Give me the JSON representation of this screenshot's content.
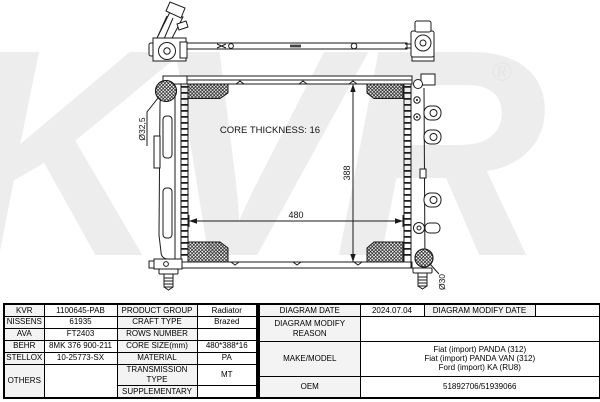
{
  "watermark": {
    "text": "KVR",
    "registered_mark": "®"
  },
  "drawing": {
    "core_thickness_label": "CORE THICKNESS: 16",
    "core_width_dim": "480",
    "core_height_dim": "388",
    "inlet_diameter_label": "Ø32,5",
    "outlet_diameter_label": "Ø30"
  },
  "spec_table": {
    "left": {
      "rows": [
        {
          "brand": "KVR",
          "part_number": "1100645-PAB",
          "property": "PRODUCT GROUP",
          "value": "Radiator"
        },
        {
          "brand": "NISSENS",
          "part_number": "61935",
          "property": "CRAFT TYPE",
          "value": "Brazed"
        },
        {
          "brand": "AVA",
          "part_number": "FT2403",
          "property": "ROWS NUMBER",
          "value": ""
        },
        {
          "brand": "BEHR",
          "part_number": "8MK 376 900-211",
          "property": "CORE SIZE(mm)",
          "value": "480*388*16"
        },
        {
          "brand": "STELLOX",
          "part_number": "10-25773-SX",
          "property": "MATERIAL",
          "value": "PA"
        },
        {
          "brand": "OTHERS",
          "part_number": "",
          "property": "TRANSMISSION TYPE",
          "value": "MT"
        },
        {
          "brand": "",
          "part_number": "",
          "property": "SUPPLEMENTARY",
          "value": ""
        }
      ]
    },
    "right": {
      "diagram_date_label": "DIAGRAM DATE",
      "diagram_date_value": "2024.07.04",
      "diagram_modify_date_label": "DIAGRAM MODIFY DATE",
      "diagram_modify_date_value": "",
      "diagram_modify_reason_label": "DIAGRAM MODIFY REASON",
      "diagram_modify_reason_value": "",
      "make_model_label": "MAKE/MODEL",
      "make_model_values": [
        "Fiat (import) PANDA (312)",
        "Fiat (import) PANDA VAN (312)",
        "Ford (import) KA (RU8)"
      ],
      "oem_label": "OEM",
      "oem_value": "51892706/51939066"
    }
  }
}
